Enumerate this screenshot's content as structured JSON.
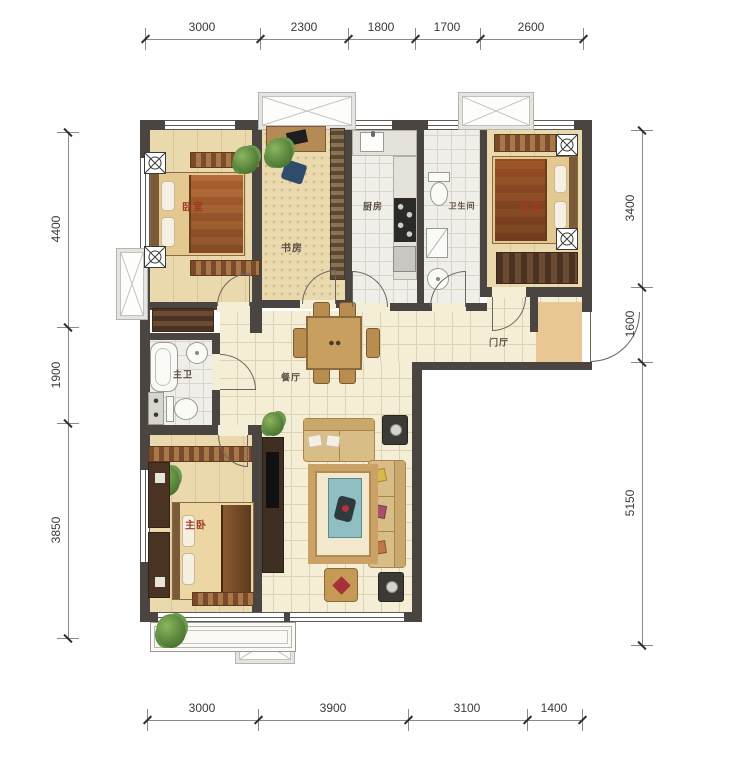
{
  "dimensions": {
    "top": [
      "3000",
      "2300",
      "1800",
      "1700",
      "2600"
    ],
    "bottom": [
      "3000",
      "3900",
      "3100",
      "1400"
    ],
    "left": [
      "4400",
      "1900",
      "3850"
    ],
    "right": [
      "3400",
      "1600",
      "5150"
    ]
  },
  "rooms": {
    "bedroom_nw": "卧室",
    "study": "书房",
    "kitchen": "厨房",
    "bathroom": "卫生间",
    "bedroom_ne": "卧室",
    "master_bath": "主卫",
    "dining": "餐厅",
    "foyer": "门厅",
    "master_bedroom": "主卧"
  },
  "colors": {
    "wall": "#4a4541",
    "floor_beige": "#ead9ad",
    "tile_cream": "#f5eed7",
    "tile_gray": "#efeee8",
    "bedroom_label": "#9c3a28",
    "room_label": "#5f5144"
  }
}
